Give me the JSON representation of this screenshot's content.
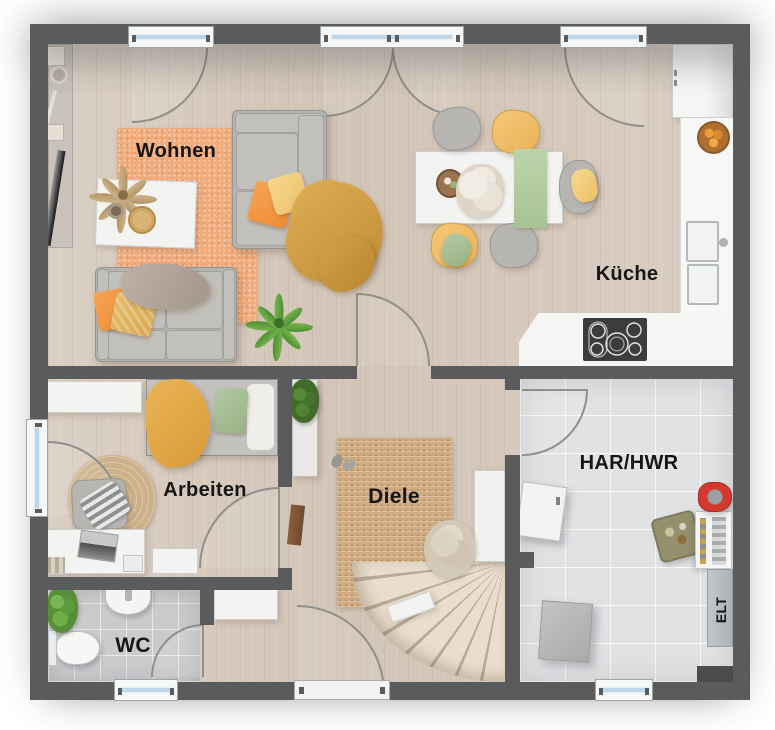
{
  "rooms": {
    "wohnen": {
      "label": "Wohnen"
    },
    "kueche": {
      "label": "Küche"
    },
    "arbeiten": {
      "label": "Arbeiten"
    },
    "diele": {
      "label": "Diele"
    },
    "wc": {
      "label": "WC"
    },
    "har_hwr": {
      "label": "HAR/HWR"
    },
    "elt": {
      "label": "ELT"
    }
  },
  "colors": {
    "wall": "#595b5d",
    "wood_floor": "#d8ccbf",
    "tile_wc": "#c9cbcd",
    "tile_har": "#e0e2e4",
    "rug_orange": "#f1ac7d",
    "rug_jute": "#cfab7f",
    "counter_white": "#f5f5f4",
    "accent_orange": "#f39a47",
    "accent_yellow": "#f2c36c",
    "accent_green": "#abc49b",
    "window_glass": "#bcd6ea"
  }
}
